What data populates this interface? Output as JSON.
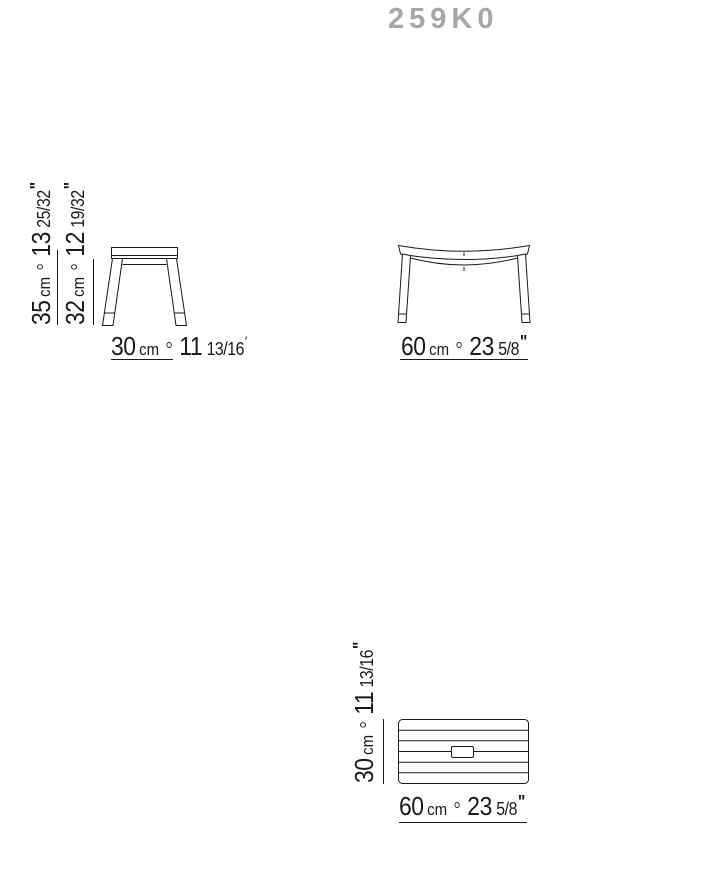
{
  "title": "259K0",
  "colors": {
    "title_gray": "#a5a7a9",
    "ink": "#1a1a1a"
  },
  "dimensions": {
    "side_height_total": {
      "value": "35",
      "unit": "cm",
      "inches": "13",
      "fraction": "25/32",
      "mark": "\""
    },
    "side_height_underseat": {
      "value": "32",
      "unit": "cm",
      "inches": "12",
      "fraction": "19/32",
      "mark": "\""
    },
    "side_depth": {
      "value": "30",
      "unit": "cm",
      "inches": "11",
      "fraction": "13/16",
      "mark": "′"
    },
    "front_width": {
      "value": "60",
      "unit": "cm",
      "inches": "23",
      "fraction": "5/8",
      "mark": "\""
    },
    "top_depth": {
      "value": "30",
      "unit": "cm",
      "inches": "11",
      "fraction": "13/16",
      "mark": "\""
    },
    "top_width": {
      "value": "60",
      "unit": "cm",
      "inches": "23",
      "fraction": "5/8",
      "mark": "\""
    }
  }
}
